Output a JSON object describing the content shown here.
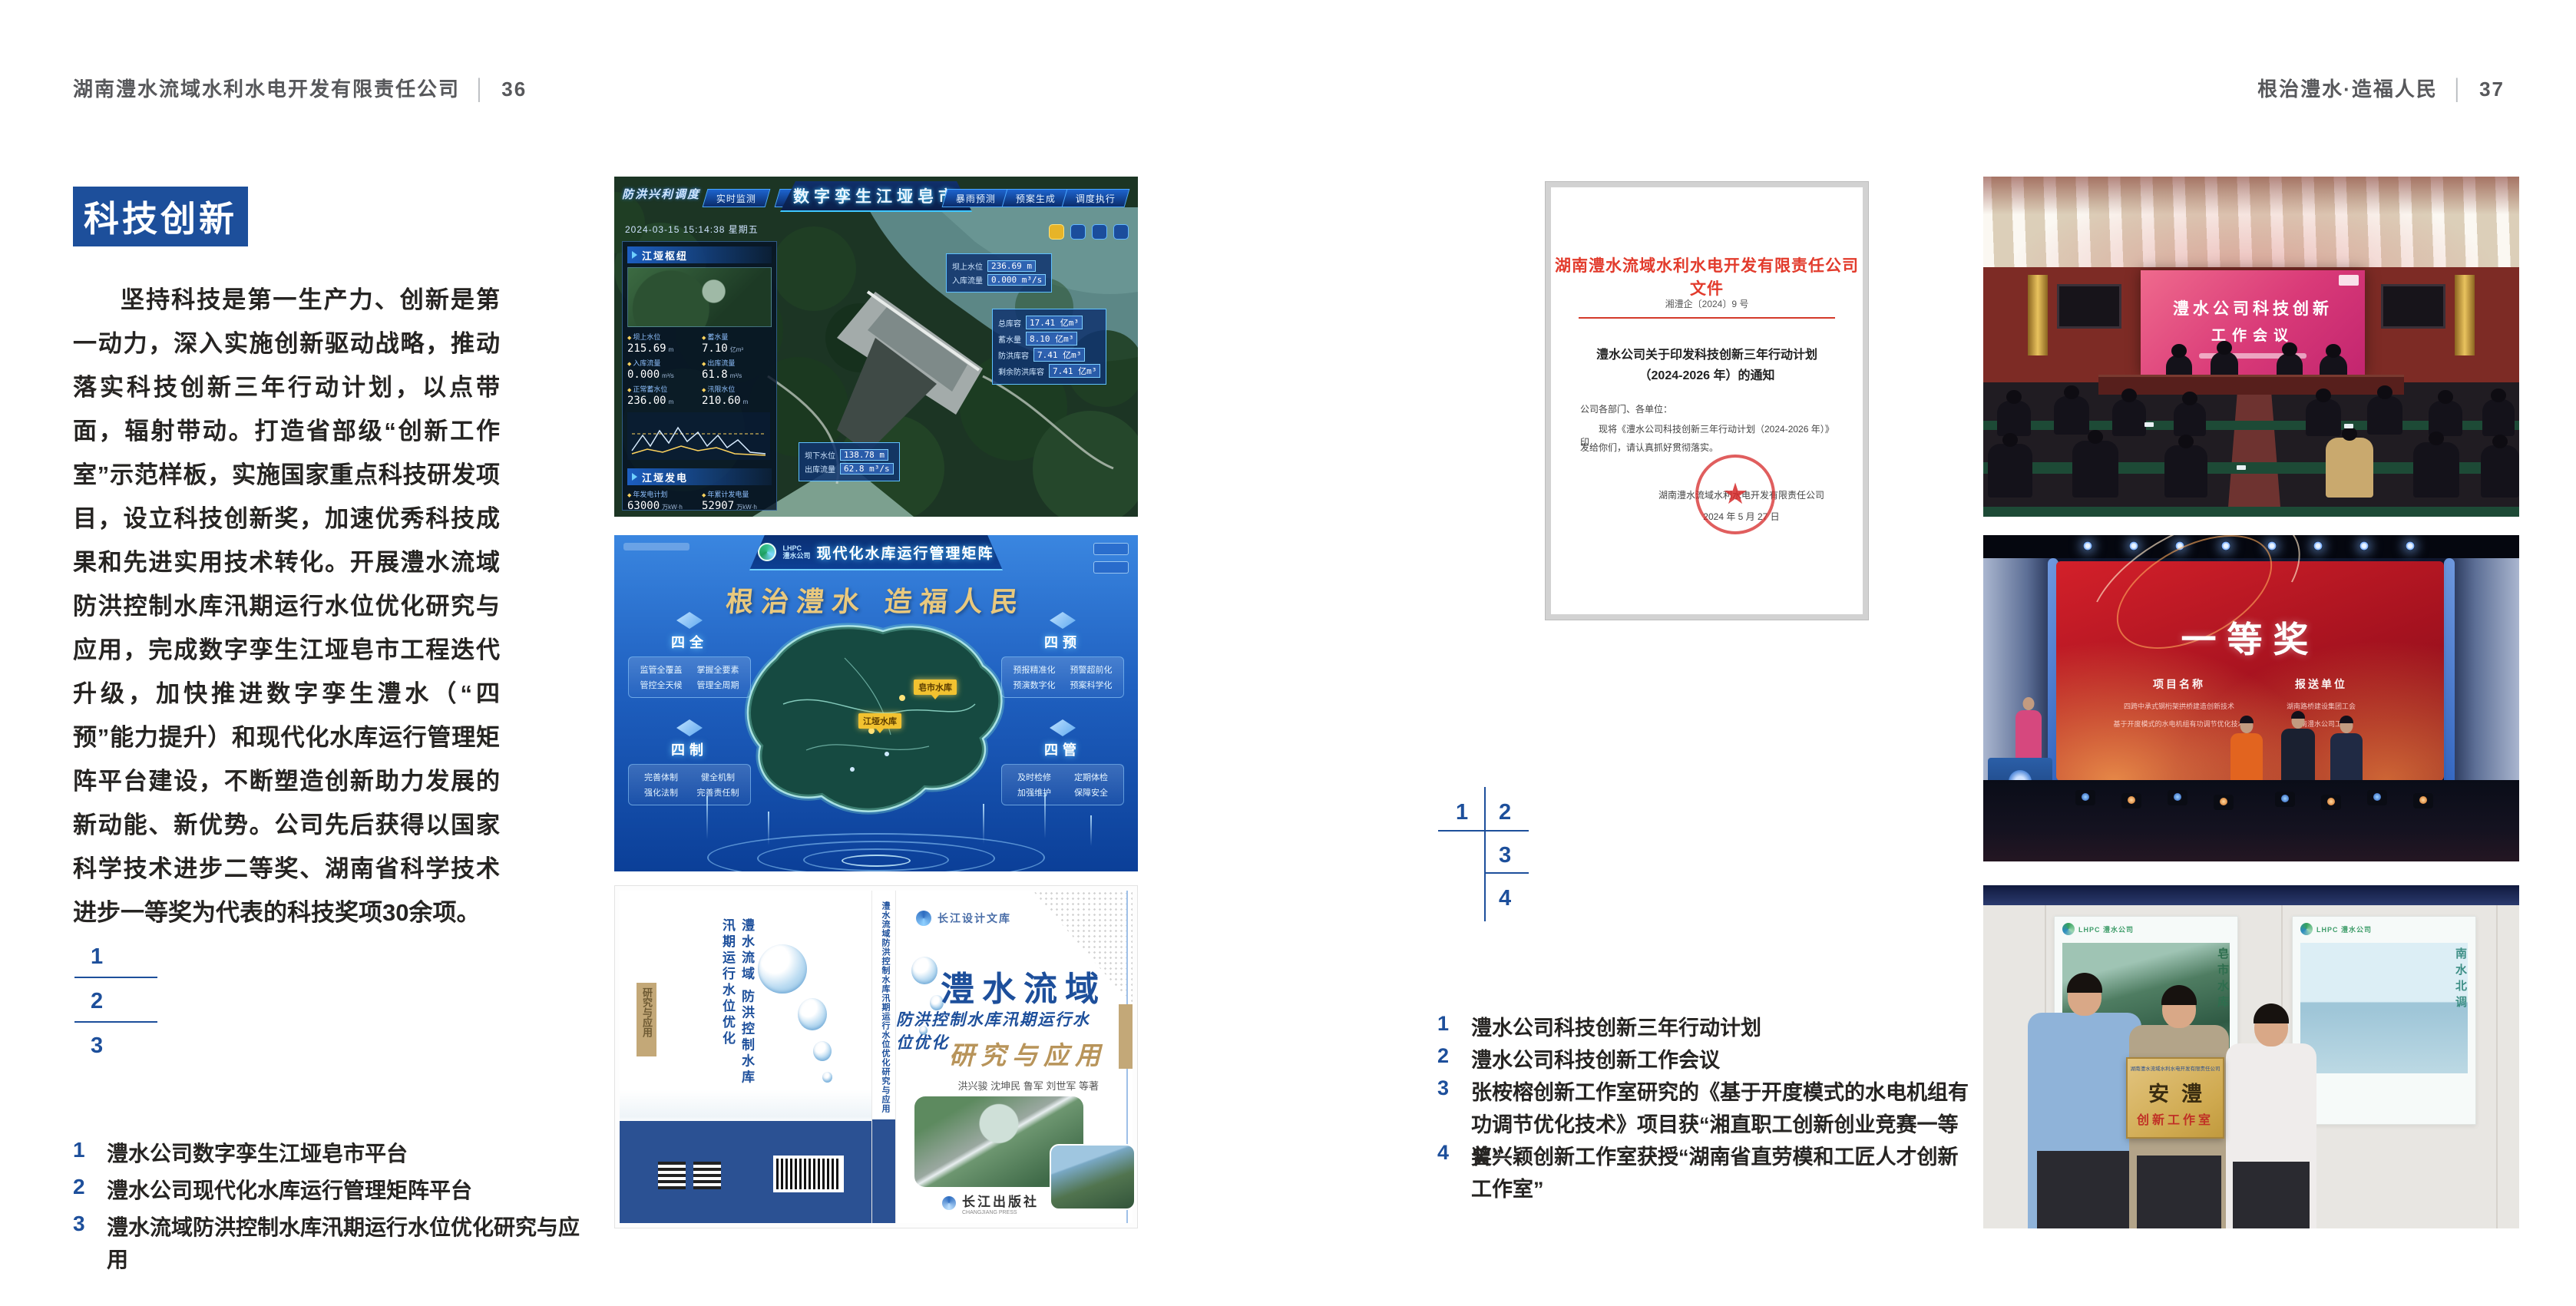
{
  "colors": {
    "accent_blue": "#1d4f9b",
    "doc_red": "#e23b2c",
    "gold": "#b8945a",
    "badge_bg": "#1d4f9b"
  },
  "page_left": {
    "header": {
      "company": "湖南澧水流域水利水电开发有限责任公司",
      "divider": "│",
      "page_no": "36"
    },
    "section_badge": "科技创新",
    "body_paragraph": "坚持科技是第一生产力、创新是第一动力，深入实施创新驱动战略，推动落实科技创新三年行动计划，以点带面，辐射带动。打造省部级“创新工作室”示范样板，实施国家重点科技研发项目，设立科技创新奖，加速优秀科技成果和先进实用技术转化。开展澧水流域防洪控制水库汛期运行水位优化研究与应用，完成数字孪生江垭皂市工程迭代升级，加快推进数字孪生澧水（“四预”能力提升）和现代化水库运行管理矩阵平台建设，不断塑造创新助力发展的新动能、新优势。公司先后获得以国家科学技术进步二等奖、湖南省科学技术进步一等奖为代表的科技奖项30余项。",
    "figure_index": {
      "n1": "1",
      "n2": "2",
      "n3": "3"
    },
    "captions": [
      {
        "no": "1",
        "text": "澧水公司数字孪生江垭皂市平台"
      },
      {
        "no": "2",
        "text": "澧水公司现代化水库运行管理矩阵平台"
      },
      {
        "no": "3",
        "text": "澧水流域防洪控制水库汛期运行水位优化研究与应用"
      }
    ]
  },
  "page_right": {
    "header": {
      "motto": "根治澧水·造福人民",
      "divider": "│",
      "page_no": "37"
    },
    "figure_index": {
      "n1": "1",
      "n2": "2",
      "n3": "3",
      "n4": "4"
    },
    "captions": [
      {
        "no": "1",
        "text": "澧水公司科技创新三年行动计划"
      },
      {
        "no": "2",
        "text": "澧水公司科技创新工作会议"
      },
      {
        "no": "3",
        "text": "张桉榕创新工作室研究的《基于开度模式的水电机组有功调节优化技术》项目获“湘直职工创新创业竞赛一等奖”"
      },
      {
        "no": "4",
        "text": "曾兴颖创新工作室获授“湖南省直劳模和工匠人才创新工作室”"
      }
    ]
  },
  "dashboard": {
    "title": "数字孪生江垭皂市",
    "corner_label": "防洪兴利调度",
    "tabs_left": [
      "实时监测",
      "洪水预报",
      "防洪预警"
    ],
    "tabs_right": [
      "暴雨预测",
      "预案生成",
      "调度执行",
      "工程巡视"
    ],
    "timestamp": "2024-03-15 15:14:38 星期五",
    "panel1_title": "江垭枢纽",
    "panel2_title": "江垭发电",
    "stats1": [
      {
        "label": "坝上水位",
        "value": "215.69",
        "unit": "m"
      },
      {
        "label": "蓄水量",
        "value": "7.10",
        "unit": "亿m³"
      },
      {
        "label": "入库流量",
        "value": "0.000",
        "unit": "m³/s"
      },
      {
        "label": "出库流量",
        "value": "61.8",
        "unit": "m³/s"
      },
      {
        "label": "正常蓄水位",
        "value": "236.00",
        "unit": "m"
      },
      {
        "label": "汛限水位",
        "value": "210.60",
        "unit": "m"
      }
    ],
    "stats2": [
      {
        "label": "年发电计划",
        "value": "63000",
        "unit": "万kW·h"
      },
      {
        "label": "年累计发电量",
        "value": "52907",
        "unit": "万kW·h"
      },
      {
        "label": "月累计发电量",
        "value": "3259.21",
        "unit": "万kW·h"
      },
      {
        "label": "当前出力",
        "value": "0.00",
        "unit": "MW"
      }
    ],
    "callout_top": {
      "rows": [
        {
          "label": "坝上水位",
          "value": "236.69 m"
        },
        {
          "label": "入库流量",
          "value": "0.000 m³/s"
        }
      ]
    },
    "callout_right": {
      "rows": [
        {
          "label": "总库容",
          "value": "17.41 亿m³"
        },
        {
          "label": "蓄水量",
          "value": "8.10 亿m³"
        },
        {
          "label": "防洪库容",
          "value": "7.41 亿m³"
        },
        {
          "label": "剩余防洪库容",
          "value": "7.41 亿m³"
        }
      ]
    },
    "callout_bottom": {
      "rows": [
        {
          "label": "坝下水位",
          "value": "138.78 m"
        },
        {
          "label": "出库流量",
          "value": "62.8 m³/s"
        }
      ]
    }
  },
  "matrix": {
    "logo_line1": "LHPC",
    "logo_line2": "澧水公司",
    "title": "现代化水库运行管理矩阵",
    "slogan": "根治澧水 造福人民",
    "panels": [
      {
        "name": "四全",
        "items": [
          "监管全覆盖",
          "掌握全要素",
          "管控全天候",
          "管理全周期"
        ]
      },
      {
        "name": "四预",
        "items": [
          "预报精准化",
          "预警超前化",
          "预演数字化",
          "预案科学化"
        ]
      },
      {
        "name": "四制",
        "items": [
          "完善体制",
          "健全机制",
          "强化法制",
          "完善责任制"
        ]
      },
      {
        "name": "四管",
        "items": [
          "及时检修",
          "定期体检",
          "加强维护",
          "保障安全"
        ]
      }
    ],
    "map_tags": [
      "皂市水库",
      "江垭水库"
    ]
  },
  "book": {
    "series": "长江设计文库",
    "title_main": "澧水流域",
    "title_sub": "防洪控制水库汛期运行水位优化",
    "title_tail": "研究与应用",
    "authors": "洪兴骏 沈坤民 鲁军 刘世军 等著",
    "back_vertical_title": "澧水流域 防洪控制水库汛期运行水位优化",
    "back_tag": "研究与应用",
    "spine_text": "澧水流域防洪控制水库汛期运行水位优化研究与应用",
    "publisher": "长江出版社",
    "publisher_en": "CHANGJIANG PRESS"
  },
  "document": {
    "header": "湖南澧水流域水利水电开发有限责任公司文件",
    "doc_no": "湘澧企〔2024〕9 号",
    "title_line1": "澧水公司关于印发科技创新三年行动计划",
    "title_line2": "（2024-2026 年）的通知",
    "salutation": "公司各部门、各单位：",
    "body_line1": "现将《澧水公司科技创新三年行动计划（2024-2026 年）》印",
    "body_line2": "发给你们，请认真抓好贯彻落实。",
    "signature": "湖南澧水流域水利水电开发有限责任公司",
    "date": "2024 年 5 月 27 日",
    "seal_star": "★"
  },
  "meeting": {
    "screen_line1": "澧水公司科技创新",
    "screen_line2": "工作会议"
  },
  "award": {
    "headline": "一等奖",
    "col1_header": "项目名称",
    "col1_items": [
      "四跨中承式钢桁架拱桥建造创新技术",
      "基于开度模式的水电机组有功调节优化技术"
    ],
    "col2_header": "报送单位",
    "col2_items": [
      "湖南路桥建设集团工会",
      "湖南澧水公司工会"
    ]
  },
  "plaque": {
    "org_line": "湖南澧水流域水利水电开发有限责任公司",
    "name_big": "安澧",
    "name_sub": "创新工作室",
    "poster_left_logo": "LHPC 澧水公司",
    "poster_left_title": "皂市水库",
    "poster_right_logo": "LHPC 澧水公司",
    "poster_right_title": "南水北调"
  }
}
